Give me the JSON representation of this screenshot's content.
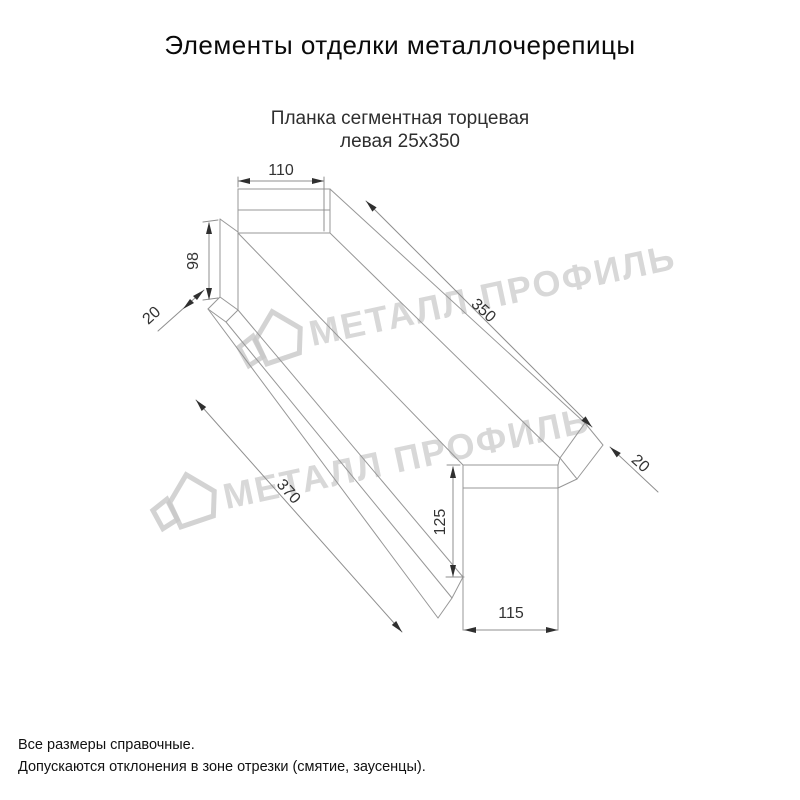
{
  "title": "Элементы отделки металлочерепицы",
  "product": {
    "line1": "Планка сегментная торцевая",
    "line2": "левая 25х350"
  },
  "dimensions": {
    "top_width": "110",
    "near_height": "98",
    "near_fold": "20",
    "top_length": "350",
    "bottom_length": "370",
    "far_height": "125",
    "far_width": "115",
    "far_fold": "20"
  },
  "watermark": "МЕТАЛЛ ПРОФИЛЬ",
  "footer": {
    "line1": "Все размеры справочные.",
    "line2": "Допускаются отклонения в зоне отрезки (смятие, заусенцы)."
  },
  "colors": {
    "background": "#ffffff",
    "drawing_line": "#979797",
    "dimension_text": "#333333",
    "arrow": "#2f2f2f",
    "title_text": "#0a0a0a",
    "watermark": "#cbcbcb"
  }
}
